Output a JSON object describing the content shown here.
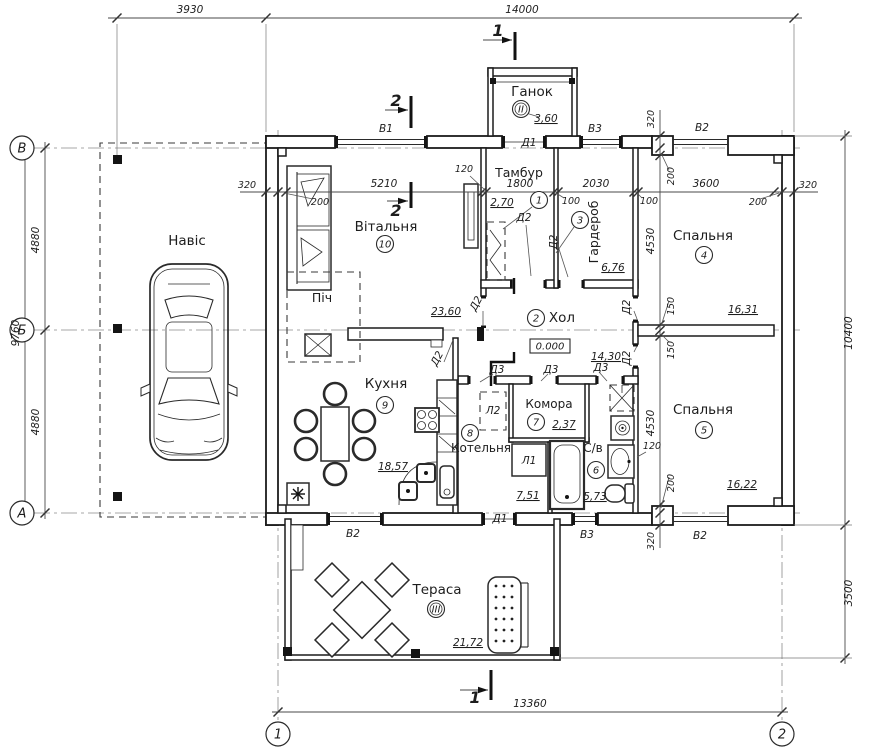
{
  "axis_labels": {
    "row_v": "В",
    "row_b": "Б",
    "row_a": "А",
    "col_1": "1",
    "col_2": "2"
  },
  "ov": {
    "top_offset": "3930",
    "top_total": "14000",
    "left_total": "9760",
    "left_half": "4880",
    "right_total": "10400",
    "terrace_depth": "3500",
    "bottom_axes": "13360"
  },
  "dims": {
    "d320": "320",
    "d200": "200",
    "d150": "150",
    "d100": "100",
    "d120": "120",
    "d5210": "5210",
    "d1800": "1800",
    "d2030": "2030",
    "d3600": "3600",
    "d4530": "4530"
  },
  "rooms": {
    "ganok": {
      "name": "Ганок",
      "number": "II",
      "area": "3,60"
    },
    "tambur": {
      "name": "Тамбур",
      "number": "1",
      "area": "2,70"
    },
    "vitalnya": {
      "name": "Вітальня",
      "number": "10",
      "area": "23,60"
    },
    "garderob": {
      "name": "Гардероб",
      "number": "3",
      "area": "6,76"
    },
    "hol": {
      "name": "Хол",
      "number": "2",
      "area": "14,30"
    },
    "spalnya4": {
      "name": "Спальня",
      "number": "4",
      "area": "16,31"
    },
    "spalnya5": {
      "name": "Спальня",
      "number": "5",
      "area": "16,22"
    },
    "kuhnya": {
      "name": "Кухня",
      "number": "9",
      "area": "18,57"
    },
    "kotelnya": {
      "name": "Котельня",
      "number": "8",
      "area": "7,51"
    },
    "komora": {
      "name": "Комора",
      "number": "7",
      "area": "2,37"
    },
    "sv": {
      "name": "С/в",
      "number": "6",
      "area": "5,73"
    },
    "terasa": {
      "name": "Тераса",
      "number": "III",
      "area": "21,72"
    },
    "navis": {
      "name": "Навіс"
    },
    "pich": {
      "name": "Піч"
    }
  },
  "op": {
    "v1": "В1",
    "v2": "В2",
    "v3": "В3",
    "d1": "Д1",
    "d2": "Д2",
    "d3": "Д3",
    "l1": "Л1",
    "l2": "Л2"
  },
  "level_mark": "0.000",
  "sec": {
    "s1": "1",
    "s2": "2"
  }
}
